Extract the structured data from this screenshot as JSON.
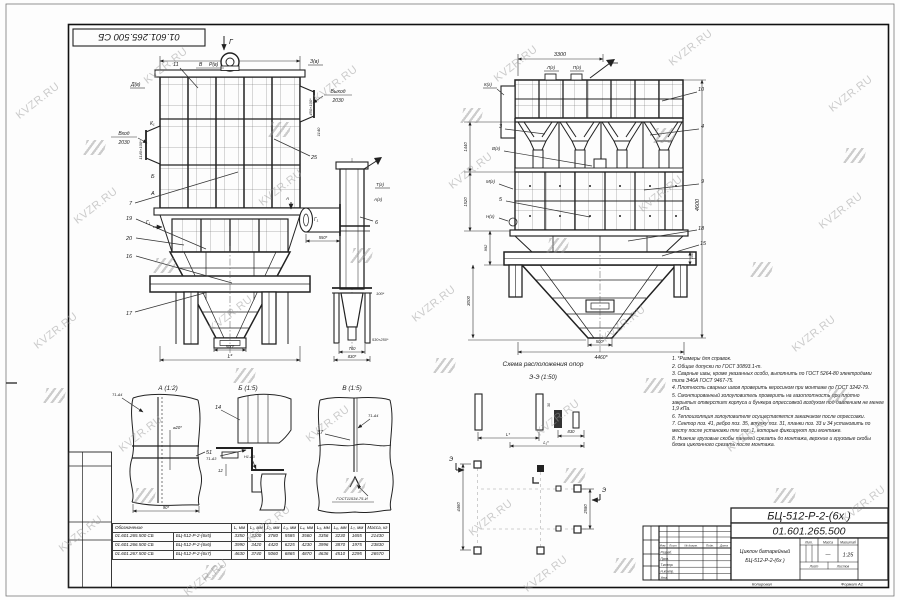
{
  "watermark": {
    "text": "KVZR.RU"
  },
  "stamp": {
    "code": "01.601.265.500 СБ"
  },
  "left_view": {
    "sec_g": "Г",
    "dim_l4": "L₄",
    "pos11": "11",
    "mark_v": "В",
    "mark_rv": "Р(в)",
    "mark_zv": "З(в)",
    "mark_dv": "Д(в)",
    "outlet_word": "Выход",
    "outlet_val": "2030",
    "inlet_word": "Вход",
    "inlet_val": "2030",
    "dim_right_1": "450×100*",
    "dim_right_2": "1140",
    "dim_left_1": "1140×100*",
    "mark_k1": "К₁",
    "mark_b": "Б",
    "mark_a": "А",
    "pos7": "7",
    "pos19": "19",
    "pos20": "20",
    "pos16": "16",
    "pos17": "17",
    "pos25": "25",
    "sec_g1": "Г₁",
    "dim_500": "500*",
    "dim_l": "L*"
  },
  "side_view": {
    "mark_tg": "Т(г)",
    "mark_ag": "А(г)",
    "mark_a": "А",
    "pos6": "6",
    "sec_g1": "Г₁",
    "dim_550": "550*",
    "dim_100": "100*",
    "dim_530": "530×250*",
    "dim_760": "760",
    "dim_830": "830*"
  },
  "right_view": {
    "dim_3300": "3300",
    "mark_lg": "Л(г)",
    "mark_pg": "П(г)",
    "mark_kg": "К(г)",
    "mark_vg": "В(г)",
    "mark_mg": "М(г)",
    "mark_ng": "Н(г)",
    "pos10": "10",
    "pos3": "3",
    "pos4": "4",
    "pos9": "9",
    "pos5": "5",
    "pos18": "18",
    "pos15": "15",
    "dim_4600": "4600",
    "dim_1440": "1440",
    "dim_1520": "1520",
    "dim_992": "992",
    "dim_3000": "3000",
    "dim_100": "100",
    "dim_500": "500*",
    "dim_4460": "4460*"
  },
  "details": {
    "a_title": "А (1:2)",
    "a_weld": "Т1-Δ4",
    "a_dim1": "⌀20*",
    "a_pos": "51",
    "a_dim2": "90*",
    "b_title": "Б (1:5)",
    "b_pos": "14",
    "b_weld1": "Т1-Δ3",
    "b_weld2": "Н1-Δ3",
    "b_dim": "12",
    "v_title": "В (1:5)",
    "v_pos": "37",
    "v_weld": "Т1-Δ4",
    "v_gost": "ГОСТ11534-75-И"
  },
  "scheme": {
    "title": "Схема расположения опор",
    "subtitle": "Э-Э (1:50)",
    "dim_l": "L*",
    "dim_l1": "L₁*",
    "dim_830": "830",
    "dim_30": "30",
    "dim_4460": "4460",
    "dim_2580": "2580",
    "mark_e1": "Э",
    "mark_e2": "Э"
  },
  "notes": {
    "items": [
      "1. *Размеры для справок.",
      "2. Общие допуски по ГОСТ 30893.1-m.",
      "3. Сварные швы, кроме указанных особо, выполнить по ГОСТ 5264-80 электродами типа Э46А ГОСТ 9467-75.",
      "4. Плотность сварных швов проверить керосином при монтаже по ГОСТ 3242-79.",
      "5. Смонтированный золоуловитель проверить на газоплотность при плотно закрытых отверстиях корпуса и бункера опрессовкой воздухом под давлением не менее 1,9 кПа.",
      "6. Теплоизоляция золоуловителя осуществляется заказчиком после опрессовки.",
      "7. Сектор поз. 41, ребро поз. 35, втулку поз. 31, планки поз. 33 и 34 установить по месту после установки тяг поз. 1, которые фиксируют при монтаже.",
      "8. Нижние грузовые скобы панелей срезать до монтажа, верхние и грузовые скобы блока циклонного срезать после монтажа."
    ]
  },
  "table": {
    "header_designation": "Обозначение",
    "col_headers": [
      "L, мм",
      "L₁, мм",
      "L₂, мм",
      "L₃, мм",
      "L₄, мм",
      "L₅, мм",
      "L₆, мм",
      "L₇, мм",
      "Масса, кг"
    ],
    "rows": [
      [
        "01.601.265.500 СБ",
        "БЦ-512-Р-2-(6х5)",
        "3350",
        "3100",
        "3780",
        "5585",
        "3560",
        "3356",
        "3230",
        "1655",
        "21430"
      ],
      [
        "01.601.266.500 СБ",
        "БЦ-512-Р-2-(6х6)",
        "3990",
        "3420",
        "4420",
        "6225",
        "4230",
        "3996",
        "3870",
        "1975",
        "23830"
      ],
      [
        "01.601.267.500 СБ",
        "БЦ-512-Р-2-(6х7)",
        "4630",
        "3740",
        "5060",
        "6865",
        "4870",
        "4636",
        "4510",
        "2295",
        "26570"
      ]
    ]
  },
  "title_block": {
    "doc_number": "БЦ-512-Р-2-(6х )",
    "doc_code": "01.601.265.500",
    "part_name_1": "Циклон батарейный",
    "part_name_2": "БЦ-512-Р-2-(6х )",
    "lit_label": "Лит.",
    "mass_label": "Масса",
    "scale_label": "Масштаб",
    "mass_value": "—",
    "scale_value": "1:25",
    "chg_izm": "Изм.",
    "chg_list": "Лист",
    "chg_doc": "№ докум.",
    "chg_sign": "Подп.",
    "chg_date": "Дата",
    "sig_1": "Разраб.",
    "sig_2": "Пров.",
    "sig_3": "Т.контр.",
    "sig_4": "Н.контр.",
    "sig_5": "Утв.",
    "sheet_label": "Лист",
    "sheets_label": "Листов",
    "copied": "Копировал",
    "format": "Формат А1"
  }
}
